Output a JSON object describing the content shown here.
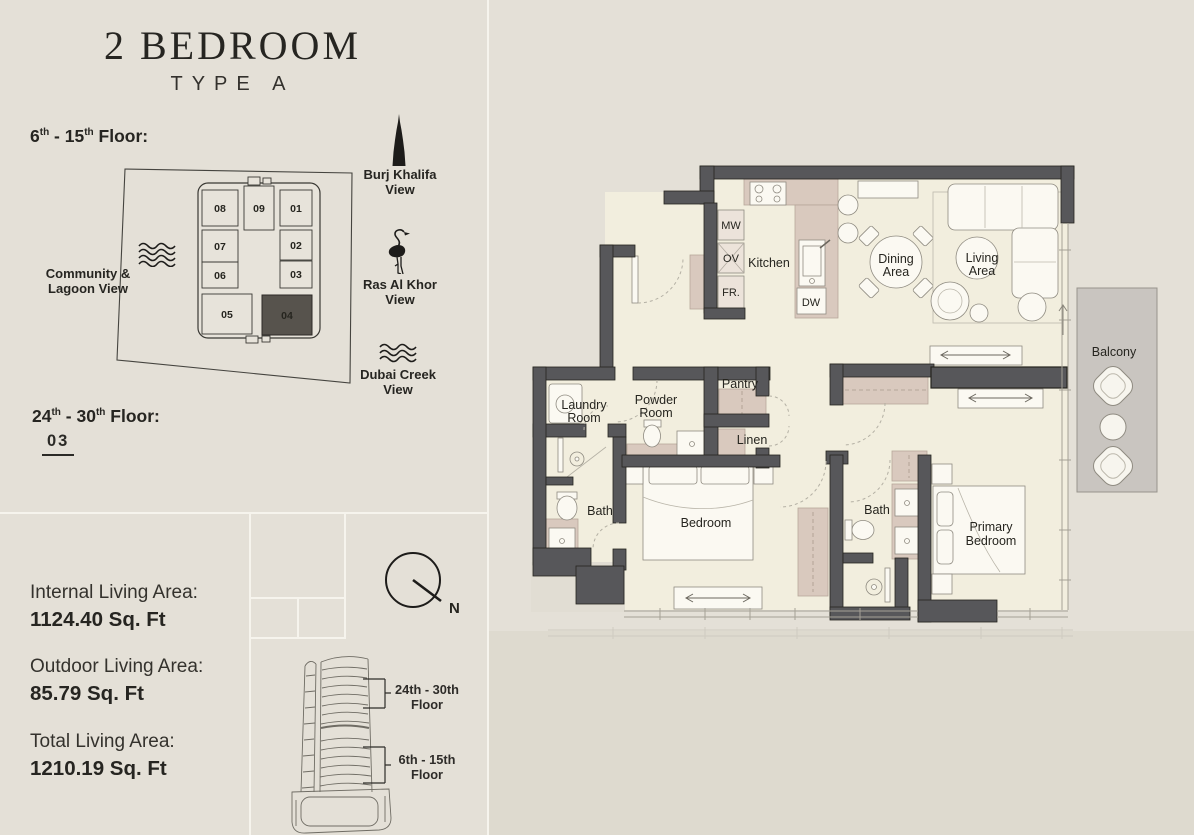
{
  "title": {
    "main": "2 BEDROOM",
    "sub": "TYPE A"
  },
  "floor_low": {
    "p1": "6",
    "s1": "th",
    "p2": " - 15",
    "s2": "th",
    "p3": " Floor:"
  },
  "floor_high": {
    "p1": "24",
    "s1": "th",
    "p2": " - 30",
    "s2": "th",
    "p3": " Floor:",
    "unit": "03"
  },
  "views": {
    "community": {
      "line1": "Community &",
      "line2": "Lagoon View"
    },
    "burj": {
      "line1": "Burj Khalifa",
      "line2": "View"
    },
    "ras": {
      "line1": "Ras Al Khor",
      "line2": "View"
    },
    "creek": {
      "line1": "Dubai Creek",
      "line2": "View"
    }
  },
  "key_plan": {
    "u01": "01",
    "u02": "02",
    "u03": "03",
    "u04": "04",
    "u05": "05",
    "u06": "06",
    "u07": "07",
    "u08": "08",
    "u09": "09",
    "highlighted_unit": "04"
  },
  "areas": {
    "internal_label": "Internal Living Area:",
    "internal_value": "1124.40 Sq. Ft",
    "outdoor_label": "Outdoor Living Area:",
    "outdoor_value": "85.79 Sq. Ft",
    "total_label": "Total Living Area:",
    "total_value": "1210.19 Sq. Ft"
  },
  "compass": {
    "n": "N"
  },
  "elevation": {
    "upper_range": "24th - 30th",
    "upper_word": "Floor",
    "lower_range": "6th - 15th",
    "lower_word": "Floor"
  },
  "plan": {
    "kitchen": "Kitchen",
    "mw": "MW",
    "ov": "OV",
    "fr": "FR.",
    "dw": "DW",
    "dining1": "Dining",
    "dining2": "Area",
    "living1": "Living",
    "living2": "Area",
    "balcony": "Balcony",
    "pantry": "Pantry",
    "linen": "Linen",
    "powder1": "Powder",
    "powder2": "Room",
    "laundry1": "Laundry",
    "laundry2": "Room",
    "bath_a": "Bath",
    "bath_b": "Bath",
    "bedroom": "Bedroom",
    "primary1": "Primary",
    "primary2": "Bedroom"
  },
  "colors": {
    "page": "#e4e0d7",
    "wall": "#57575a",
    "floor": "#f2eede",
    "cabinet_pink": "#d9c9be",
    "balcony_gray": "#c9c5c0",
    "ink": "#262521",
    "highlight_unit": "#57534d"
  }
}
